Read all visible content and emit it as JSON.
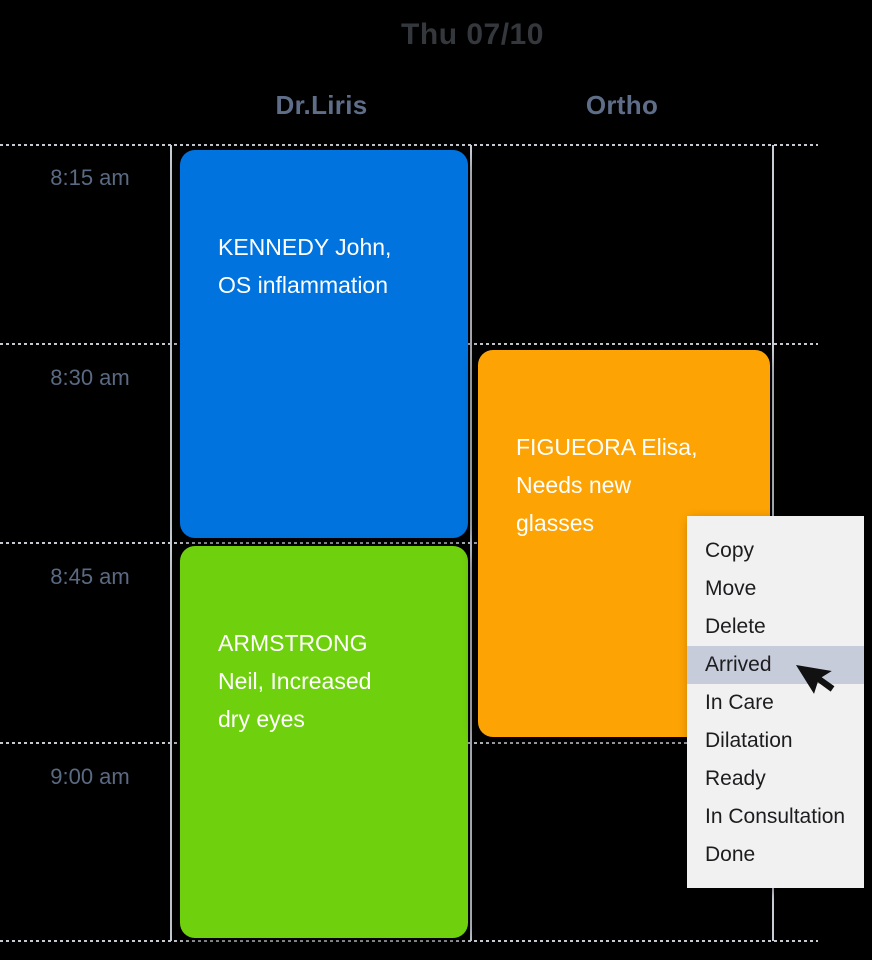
{
  "date_header": "Thu 07/10",
  "columns": [
    {
      "label": "Dr.Liris"
    },
    {
      "label": "Ortho"
    }
  ],
  "time_slots": [
    "8:15 am",
    "8:30 am",
    "8:45 am",
    "9:00 am"
  ],
  "appointments": {
    "kennedy": {
      "text": "KENNEDY John,\nOS inflammation",
      "color": "#0173de",
      "column": "Dr.Liris"
    },
    "armstrong": {
      "text": "ARMSTRONG\nNeil, Increased\ndry eyes",
      "color": "#6fd00e",
      "column": "Dr.Liris"
    },
    "figueora": {
      "text": "FIGUEORA Elisa,\nNeeds new\nglasses",
      "color": "#fda303",
      "column": "Ortho"
    }
  },
  "context_menu": {
    "items": [
      "Copy",
      "Move",
      "Delete",
      "Arrived",
      "In Care",
      "Dilatation",
      "Ready",
      "In Consultation",
      "Done"
    ],
    "highlighted_item": "Arrived",
    "background": "#f2f1f2",
    "highlight_color": "#c7ccdb"
  },
  "colors": {
    "appointment_blue": "#0173de",
    "appointment_green": "#6fd00e",
    "appointment_orange": "#fda303",
    "title_text": "#34383d",
    "header_text": "#5f6e88",
    "time_text": "#5a6a82",
    "grid_line": "#c9ced6"
  }
}
